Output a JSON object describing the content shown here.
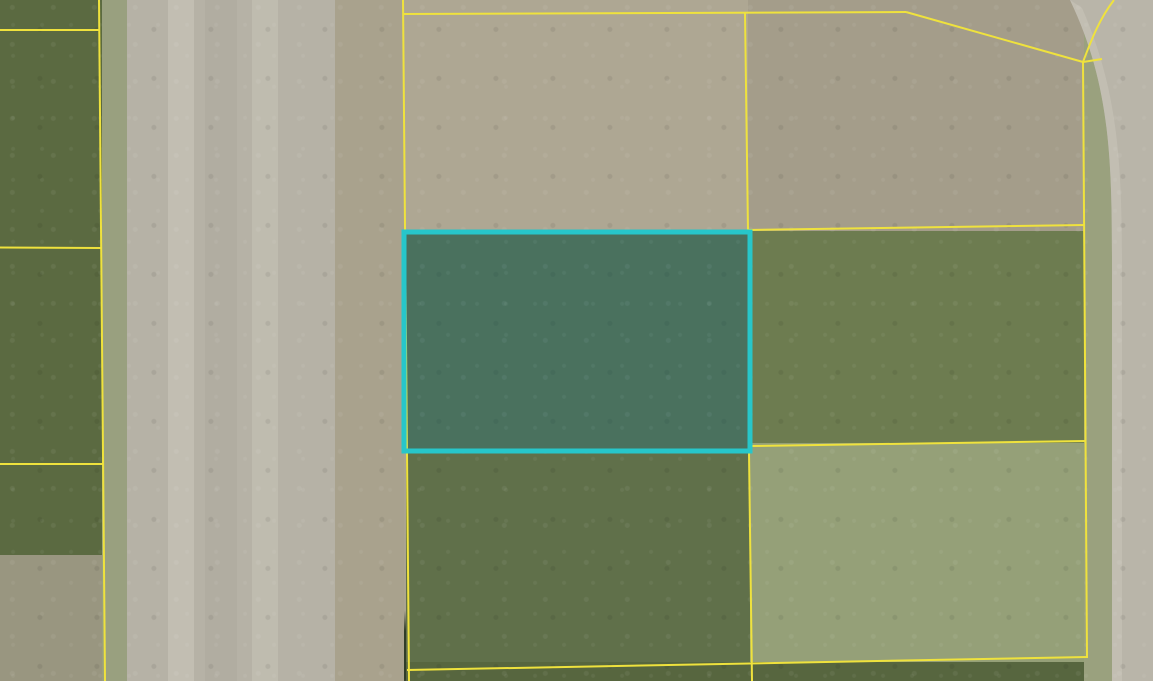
{
  "map": {
    "type": "aerial-parcel-map",
    "watermark": "FGCMLS",
    "parcel_line_color": "#efe23d",
    "highlighted_parcel": {
      "id": "03027 0040",
      "lot": "4",
      "highlight_color": "#27c6ca"
    },
    "streets": [
      {
        "name": "EISENHOWER BLVD",
        "orientation": "vertical"
      },
      {
        "name": "HOLMES AVE",
        "orientation": "vertical"
      }
    ],
    "parcels": [
      {
        "id": "02001 0280",
        "lot": "28"
      },
      {
        "id": "02001 0270",
        "lot": "27"
      },
      {
        "id": "02001 0260",
        "lot": "26"
      },
      {
        "id": "02001 0250",
        "lot": "25"
      },
      {
        "id": "03027 0010",
        "lot": "2"
      },
      {
        "id": "03027 0030",
        "lot": "3"
      },
      {
        "id": "03027 0040",
        "lot": "4"
      },
      {
        "id": "03027 0050",
        "lot": "5"
      },
      {
        "id": "03027 0060",
        "lot": "6"
      },
      {
        "id": "03027 0070",
        "lot": "7"
      },
      {
        "id": "03027 0080",
        "lot": "8"
      },
      {
        "id": "03027 0090",
        "lot": "9"
      },
      {
        "id": "03027 0100",
        "lot": "10"
      },
      {
        "id": "03027 0110",
        "lot": "11"
      }
    ]
  }
}
